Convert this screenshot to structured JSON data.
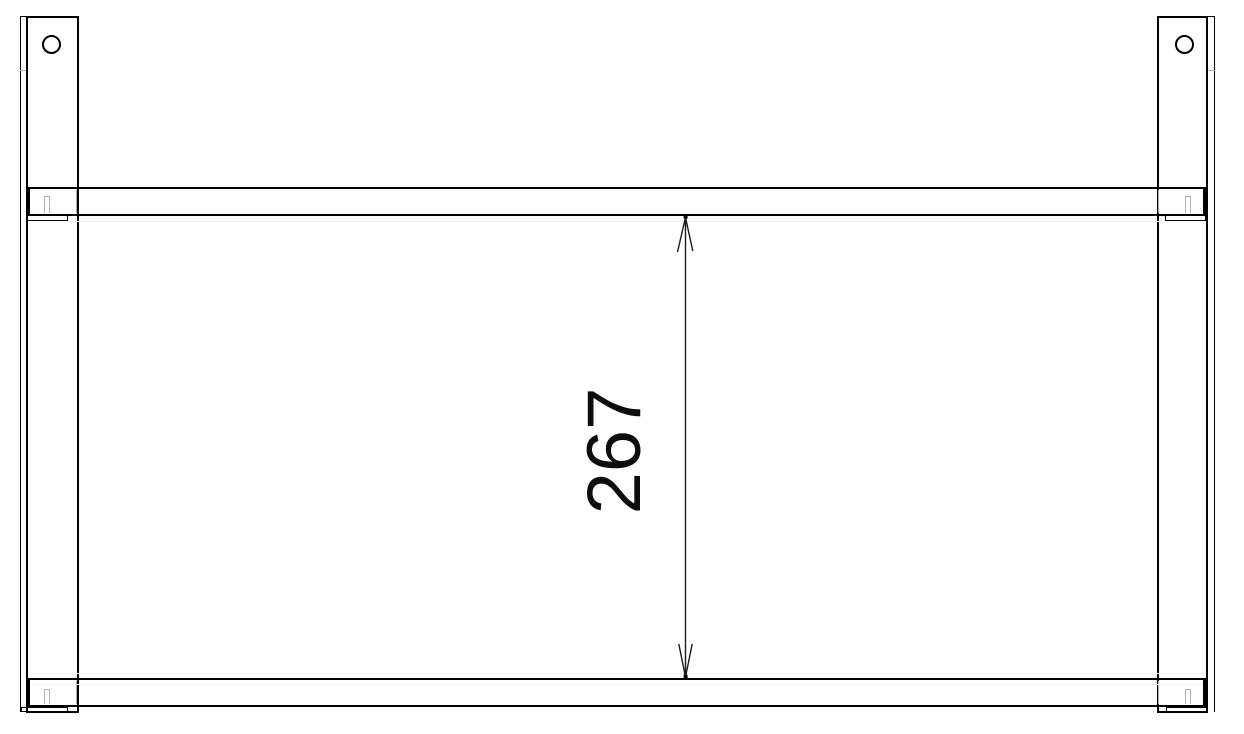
{
  "drawing": {
    "kind": "technical-drawing-front-view",
    "dimension": {
      "label": "267",
      "orientation": "vertical",
      "measures": "inner distance between top rail and bottom rail",
      "arrow_style": "open"
    },
    "parts": {
      "posts": 2,
      "rails": 2,
      "holes_per_post": 1,
      "hole_shape": "circle"
    },
    "colors": {
      "background": "#ffffff",
      "visible_line": "#000000",
      "hidden_line": "#b3b3b3",
      "dimension_text": "#0d0d0d"
    }
  }
}
